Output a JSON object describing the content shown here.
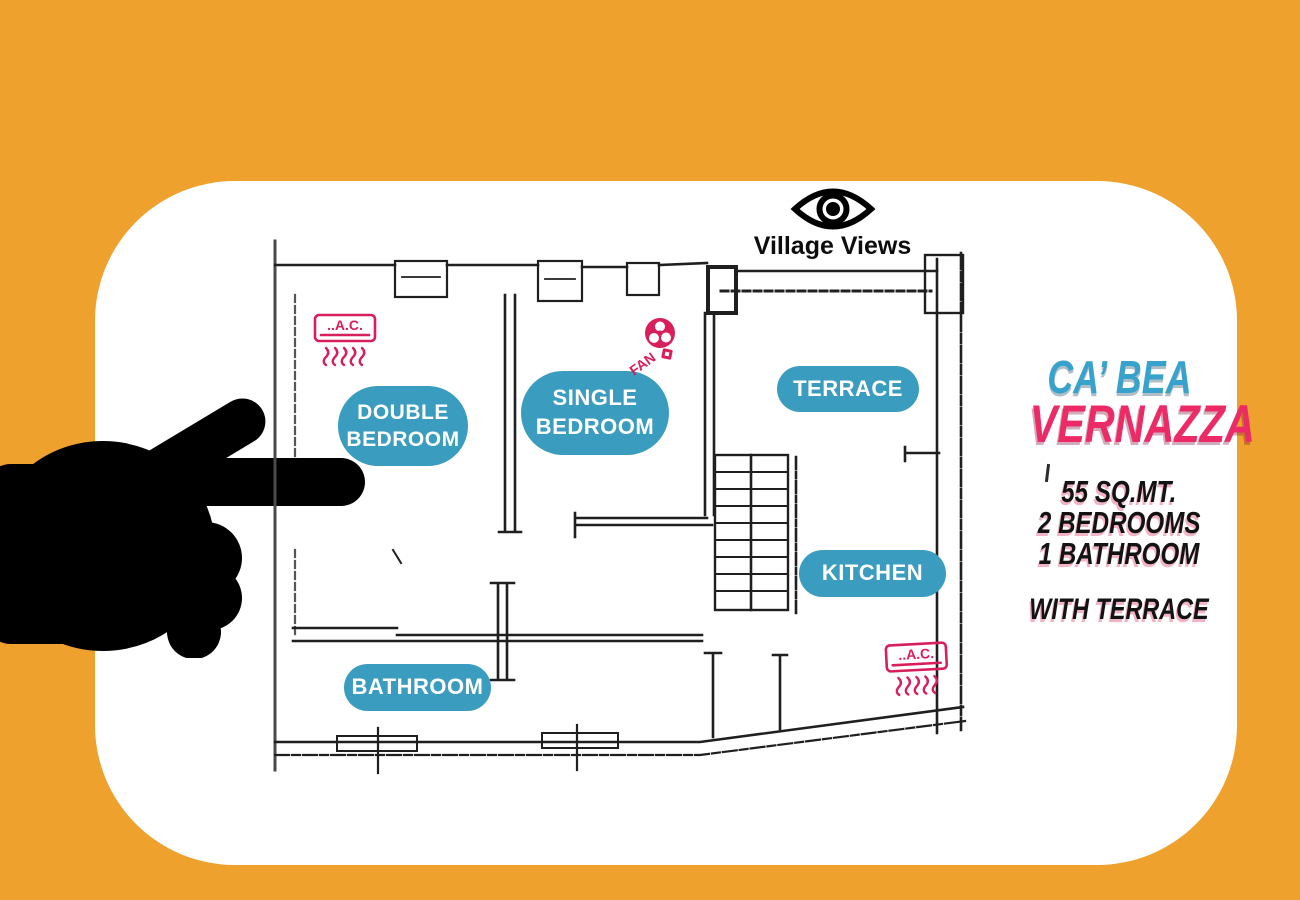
{
  "brand": {
    "name": "Village Views"
  },
  "listing": {
    "title_line1": "CA’ BEA",
    "title_line2": "VERNAZZA",
    "specs": [
      "55 SQ.MT.",
      "2 BEDROOMS",
      "1 BATHROOM"
    ],
    "feature": "WITH TERRACE"
  },
  "rooms": [
    {
      "id": "double-bedroom",
      "lines": [
        "DOUBLE",
        "BEDROOM"
      ]
    },
    {
      "id": "single-bedroom",
      "lines": [
        "SINGLE",
        "BEDROOM"
      ]
    },
    {
      "id": "terrace",
      "lines": [
        "TERRACE"
      ]
    },
    {
      "id": "kitchen",
      "lines": [
        "KITCHEN"
      ]
    },
    {
      "id": "bathroom",
      "lines": [
        "BATHROOM"
      ]
    }
  ],
  "amenities": {
    "ac_label": "..A.C.",
    "fan_label": "FAN"
  },
  "colors": {
    "background_orange": "#EEA12D",
    "card_white": "#FFFFFF",
    "room_pill_teal": "#3A9CBE",
    "amenity_pink": "#D81E5B",
    "title_blue": "#37A3CC",
    "title_pink": "#EC2A66",
    "plan_ink": "#1F1F1F",
    "hand_black": "#000000"
  }
}
